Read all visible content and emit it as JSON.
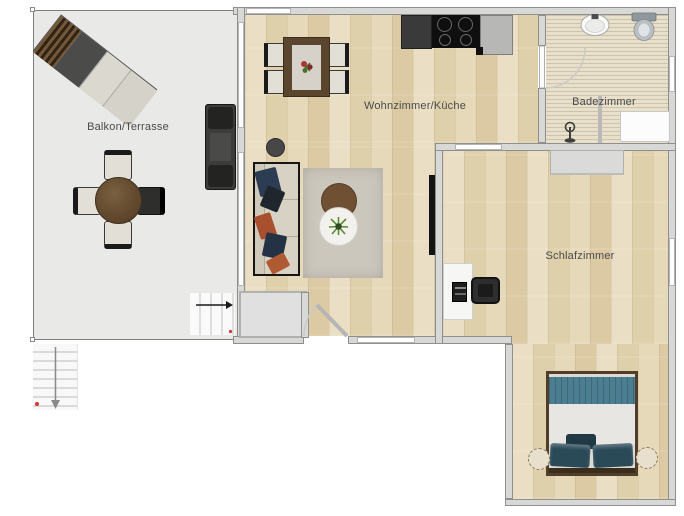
{
  "rooms": {
    "balcony": {
      "label": "Balkon/Terrasse"
    },
    "living_kitchen": {
      "label": "Wohnzimmer/Küche"
    },
    "bathroom": {
      "label": "Badezimmer"
    },
    "bedroom": {
      "label": "Schlafzimmer"
    }
  },
  "colors": {
    "wall": "#d8d8d6",
    "wood_floor": "#e5d6b4",
    "balcony_floor": "#e9e9e7",
    "bathroom_tile": "#e8e0cb",
    "bed_blanket_teal": "#4c7e92",
    "pillow_teal": "#2b4a58",
    "sofa_beige": "#d8d2c4",
    "pillow_navy": "#2c3c52",
    "pillow_rust": "#a8502e",
    "rug_gray": "#ccc7bd",
    "table_brown": "#6f5539",
    "marker_red": "#d03a34"
  },
  "icons": {
    "balcony_steps_arrow": "arrow-right",
    "exterior_stairs_arrow": "arrow-down",
    "shower": "shower-column",
    "plant": "green-plant",
    "flowers": "flower-bouquet"
  }
}
